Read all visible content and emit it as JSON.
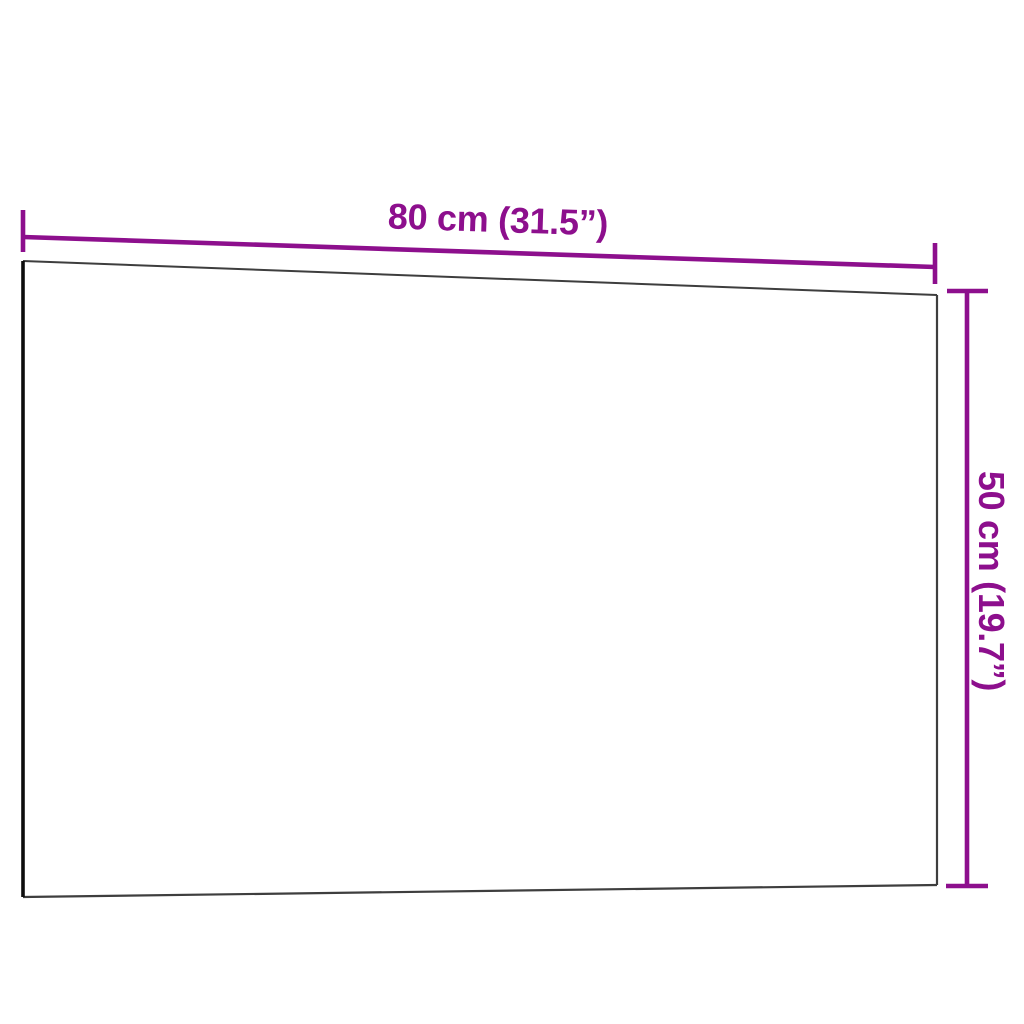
{
  "diagram": {
    "kind": "product-dimension-diagram",
    "subject": "wall-mounted rectangular board panel shown in slight perspective"
  },
  "dimensions": {
    "width_label": "80 cm (31.5”)",
    "height_label": "50 cm (19.7”)"
  },
  "colors": {
    "background": "#FFFFFF",
    "board_fill": "#FFFFFF",
    "board_edge": "#3E3E3E",
    "board_edge_left": "#0D0D0D",
    "dimension_line": "#8D0F8D",
    "dimension_text": "#8D0F8D"
  }
}
